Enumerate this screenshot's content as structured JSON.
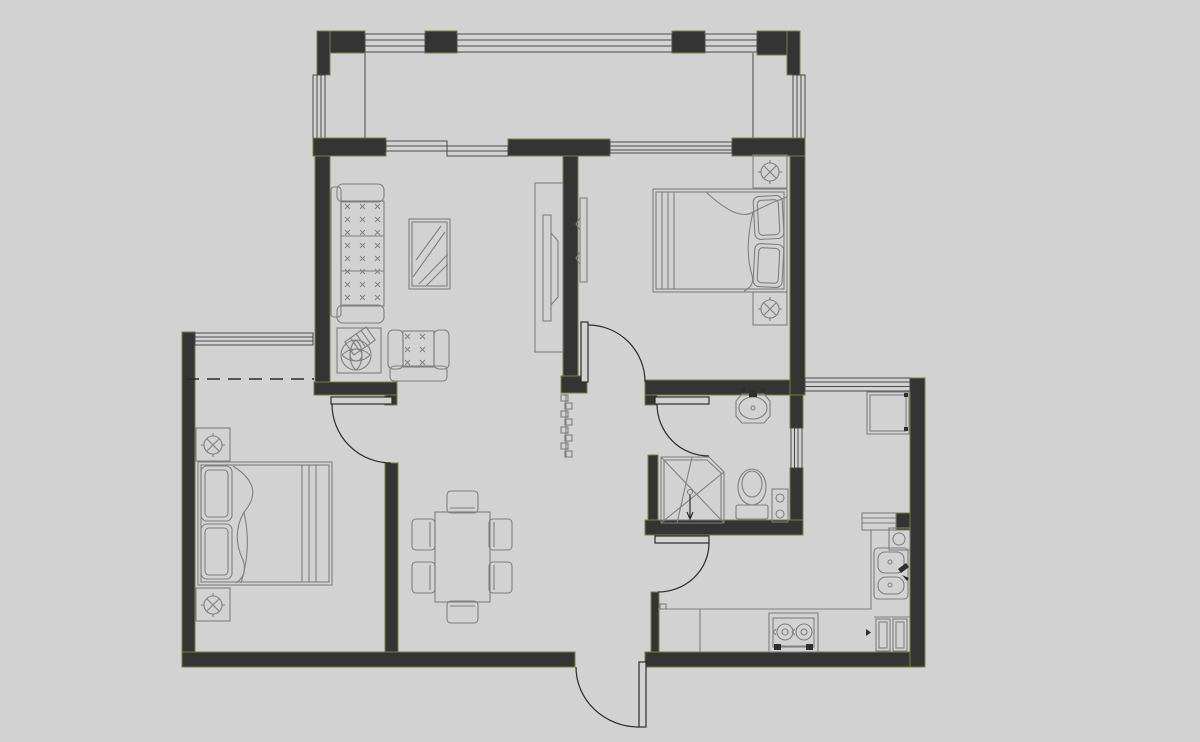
{
  "canvas": {
    "width": 1200,
    "height": 742
  },
  "colors": {
    "background": "#d2d2d2",
    "wall_fill": "#343434",
    "wall_edge": "#76803c",
    "furniture_line": "#7f7f7f",
    "door_line": "#2b2b2b",
    "window_line": "#4a4a4a",
    "accent_dark": "#2e2e2e"
  },
  "plan": {
    "type": "apartment-floor-plan",
    "rooms": [
      {
        "name": "balcony",
        "fixtures": [
          "glazed-window-band-top",
          "glazed-window-left",
          "glazed-window-right"
        ]
      },
      {
        "name": "living-room",
        "fixtures": [
          "three-seat-sofa",
          "armchair",
          "glass-coffee-table",
          "potted-plant",
          "tv-cabinet",
          "television"
        ]
      },
      {
        "name": "bedroom-top-right",
        "fixtures": [
          "double-bed",
          "pillow",
          "pillow",
          "nightstand",
          "nightstand",
          "table-lamp",
          "table-lamp",
          "wall-tv"
        ]
      },
      {
        "name": "bedroom-bottom-left",
        "fixtures": [
          "double-bed",
          "pillow",
          "pillow",
          "nightstand",
          "nightstand",
          "table-lamp",
          "table-lamp",
          "window",
          "overhead-dashed-line"
        ]
      },
      {
        "name": "dining-area",
        "fixtures": [
          "dining-table",
          "chair",
          "chair",
          "chair",
          "chair",
          "chair",
          "chair"
        ]
      },
      {
        "name": "hallway",
        "fixtures": [
          "bead-curtain",
          "entrance-door"
        ]
      },
      {
        "name": "bathroom",
        "fixtures": [
          "washbasin",
          "toilet",
          "corner-shower",
          "small-cabinet",
          "window"
        ]
      },
      {
        "name": "kitchen",
        "fixtures": [
          "refrigerator",
          "double-basin-sink",
          "two-burner-gas-stove",
          "l-shaped-counter",
          "cabinet-appliance",
          "water-heater",
          "pass-through-shelf",
          "window-band"
        ]
      }
    ],
    "doors": [
      {
        "name": "entrance-door",
        "swing": "outward-south"
      },
      {
        "name": "bedroom-top-right-door",
        "swing": "into-bedroom"
      },
      {
        "name": "bedroom-bottom-left-door",
        "swing": "into-bedroom"
      },
      {
        "name": "bathroom-door",
        "swing": "into-bathroom"
      },
      {
        "name": "kitchen-door",
        "swing": "into-kitchen"
      }
    ],
    "dining_chair_count": 6,
    "stove_burner_count": 2
  }
}
